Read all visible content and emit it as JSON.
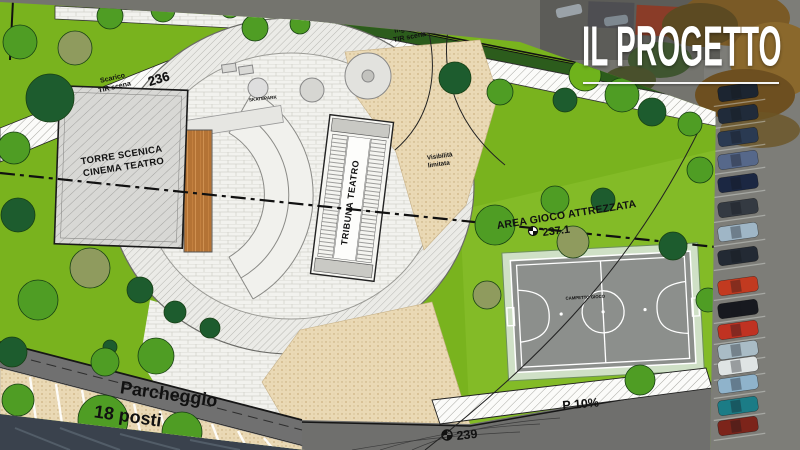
{
  "title": {
    "text": "IL PROGETTO"
  },
  "plan": {
    "building_label": {
      "line1": "TORRE SCENICA",
      "line2": "CINEMA TEATRO"
    },
    "tribuna_label": "TRIBUNA TEATRO",
    "skatepark_label": "SKATEPARK",
    "area_gioco_label": "AREA GIOCO ATTREZZATA",
    "campetto_label": "CAMPETTO GIOCO",
    "parcheggio_label": {
      "line1": "Parcheggio",
      "line2": "18 posti"
    },
    "scarico_label": {
      "line1": "Scarico",
      "line2": "TIR scena"
    },
    "ingresso_label": {
      "line1": "Ingresso",
      "line2": "TIR scena"
    },
    "visibilita_label": {
      "line1": "Visibilità",
      "line2": "limitata"
    },
    "slope_label": "P 10%",
    "elevations": {
      "e236": "236",
      "e237": "237.1",
      "e239": "239"
    }
  },
  "colors": {
    "lawn": "#79b31e",
    "lawn_bright": "#83bb27",
    "tree_dark": "#1d5c2e",
    "tree_mid": "#4f9d24",
    "tree_olive": "#8f9b5e",
    "tree_lime": "#6fb31c",
    "pitch_gray": "#8c8f8c",
    "road_gray": "#6f6f6d",
    "sand": "#ead9b5",
    "title_white": "#ffffff"
  },
  "decor": {
    "trees": [
      {
        "x": 20,
        "y": 42,
        "r": 17,
        "t": "m"
      },
      {
        "x": 75,
        "y": 48,
        "r": 17,
        "t": "o"
      },
      {
        "x": 50,
        "y": 98,
        "r": 24,
        "t": "d"
      },
      {
        "x": 110,
        "y": 16,
        "r": 13,
        "t": "m"
      },
      {
        "x": 163,
        "y": 10,
        "r": 12,
        "t": "m"
      },
      {
        "x": 230,
        "y": 8,
        "r": 10,
        "t": "m"
      },
      {
        "x": 14,
        "y": 148,
        "r": 16,
        "t": "m"
      },
      {
        "x": 18,
        "y": 215,
        "r": 17,
        "t": "d"
      },
      {
        "x": 90,
        "y": 268,
        "r": 20,
        "t": "o"
      },
      {
        "x": 38,
        "y": 300,
        "r": 20,
        "t": "m"
      },
      {
        "x": 12,
        "y": 352,
        "r": 15,
        "t": "d"
      },
      {
        "x": 110,
        "y": 347,
        "r": 7,
        "t": "d"
      },
      {
        "x": 105,
        "y": 362,
        "r": 14,
        "t": "m"
      },
      {
        "x": 18,
        "y": 400,
        "r": 16,
        "t": "m"
      },
      {
        "x": 103,
        "y": 420,
        "r": 25,
        "t": "m"
      },
      {
        "x": 182,
        "y": 432,
        "r": 20,
        "t": "m"
      },
      {
        "x": 156,
        "y": 356,
        "r": 18,
        "t": "m"
      },
      {
        "x": 140,
        "y": 290,
        "r": 13,
        "t": "d"
      },
      {
        "x": 175,
        "y": 312,
        "r": 11,
        "t": "d"
      },
      {
        "x": 210,
        "y": 328,
        "r": 10,
        "t": "d"
      },
      {
        "x": 255,
        "y": 28,
        "r": 13,
        "t": "m"
      },
      {
        "x": 300,
        "y": 24,
        "r": 10,
        "t": "m"
      },
      {
        "x": 455,
        "y": 78,
        "r": 16,
        "t": "d"
      },
      {
        "x": 500,
        "y": 92,
        "r": 13,
        "t": "m"
      },
      {
        "x": 495,
        "y": 225,
        "r": 20,
        "t": "m"
      },
      {
        "x": 555,
        "y": 200,
        "r": 14,
        "t": "m"
      },
      {
        "x": 603,
        "y": 200,
        "r": 12,
        "t": "d"
      },
      {
        "x": 573,
        "y": 242,
        "r": 16,
        "t": "o"
      },
      {
        "x": 487,
        "y": 295,
        "r": 14,
        "t": "o"
      },
      {
        "x": 673,
        "y": 246,
        "r": 14,
        "t": "d"
      },
      {
        "x": 700,
        "y": 170,
        "r": 13,
        "t": "m"
      },
      {
        "x": 708,
        "y": 300,
        "r": 12,
        "t": "m"
      },
      {
        "x": 640,
        "y": 380,
        "r": 15,
        "t": "m"
      },
      {
        "x": 585,
        "y": 75,
        "r": 16,
        "t": "l"
      },
      {
        "x": 622,
        "y": 95,
        "r": 17,
        "t": "m"
      },
      {
        "x": 565,
        "y": 100,
        "r": 12,
        "t": "d"
      },
      {
        "x": 652,
        "y": 112,
        "r": 14,
        "t": "d"
      },
      {
        "x": 690,
        "y": 124,
        "r": 12,
        "t": "m"
      }
    ],
    "cars": [
      {
        "y": 92,
        "c": "#1c2531"
      },
      {
        "y": 114,
        "c": "#202b3a"
      },
      {
        "y": 137,
        "c": "#2a3a52"
      },
      {
        "y": 160,
        "c": "#56688a"
      },
      {
        "y": 183,
        "c": "#1b2742"
      },
      {
        "y": 208,
        "c": "#343a42"
      },
      {
        "y": 232,
        "c": "#9fb6c6"
      },
      {
        "y": 256,
        "c": "#232a34"
      },
      {
        "y": 286,
        "c": "#c23a20"
      },
      {
        "y": 309,
        "c": "#17191f"
      },
      {
        "y": 330,
        "c": "#c03222"
      },
      {
        "y": 350,
        "c": "#a9bcc6"
      },
      {
        "y": 366,
        "c": "#dfe4e4"
      },
      {
        "y": 384,
        "c": "#8fb3cb"
      },
      {
        "y": 406,
        "c": "#1b7c86"
      },
      {
        "y": 426,
        "c": "#7c241a"
      }
    ]
  }
}
